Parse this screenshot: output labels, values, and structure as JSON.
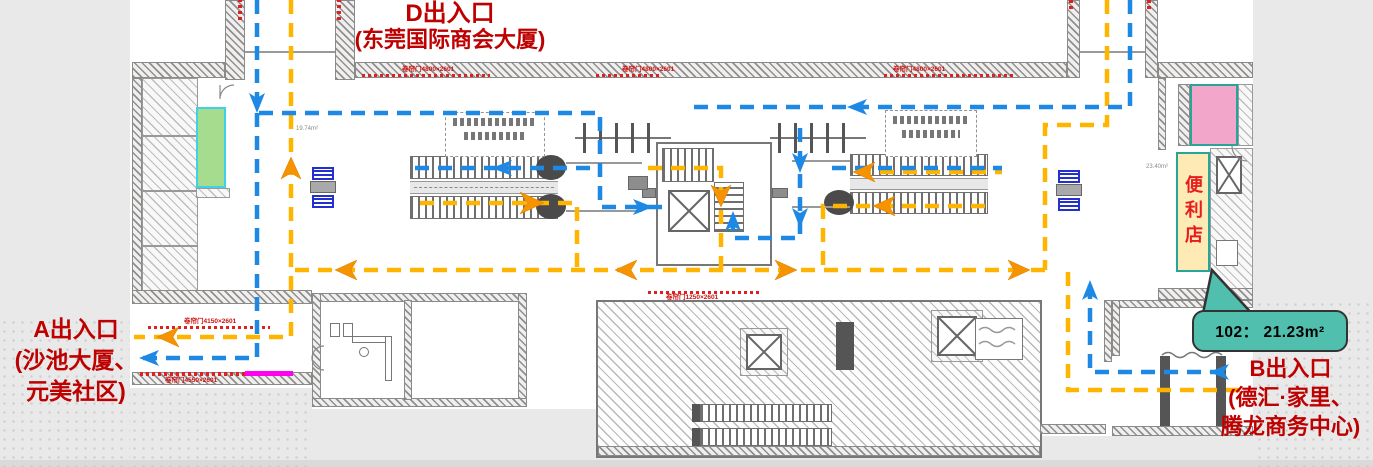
{
  "colors": {
    "flow-blue": "#1E88E5",
    "flow-orange": "#FFB400",
    "arrow-orange": "#F59300",
    "label-red": "#BE0000",
    "room-green": "#A6DC8E",
    "room-green-border": "#3FD1E8",
    "room-pink": "#F2A6CA",
    "teal-border": "#28A598",
    "store-yellow": "#FDEAB5",
    "store-red": "#E81C1C",
    "callout-fill": "#50BFAE",
    "magenta": "#FF00F0"
  },
  "labels": {
    "exit_d": {
      "title": "D出入口",
      "subtitle": "(东莞国际商会大厦)"
    },
    "exit_a": {
      "title": "A出入口",
      "line2": "(沙池大厦、",
      "line3": "元美社区)"
    },
    "exit_b": {
      "title": "B出入口",
      "line2": "(德汇·家里、",
      "line3": "腾龙商务中心)"
    },
    "store": {
      "name": "便利店"
    },
    "callout": {
      "text": "102： 21.23m²"
    },
    "area_notes": {
      "left_room": "19.74m²",
      "store_side": "23.40m²"
    },
    "wall_notes": {
      "n1": "卷帘门4800×2601",
      "n2": "卷帘门4800×2601",
      "n3": "卷帘门4800×2601",
      "n4": "卷帘门4150×2601",
      "n5": "卷帘门4550×2601",
      "n6": "卷帘门1250×2601"
    }
  }
}
